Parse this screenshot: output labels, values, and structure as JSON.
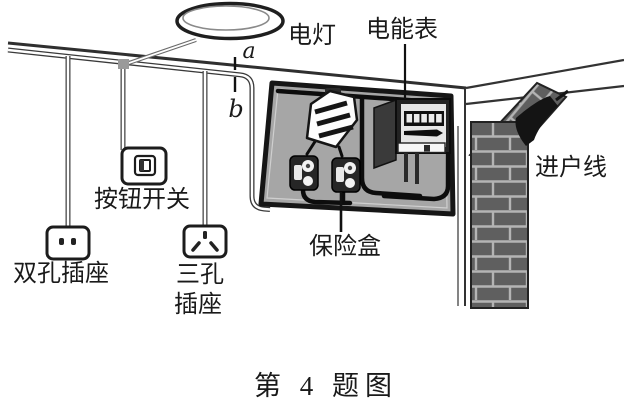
{
  "figure": {
    "type": "household-electric-circuit-diagram",
    "caption": "第 4 题图",
    "labels": {
      "lamp": "电灯",
      "energy_meter": "电能表",
      "service_entrance_line": "进户线",
      "push_button_switch": "按钮开关",
      "two_hole_socket": "双孔插座",
      "three_hole_socket_line1": "三孔",
      "three_hole_socket_line2": "插座",
      "fuse_box": "保险盒",
      "point_a": "a",
      "point_b": "b"
    },
    "colors": {
      "ink": "#1a1a1a",
      "panel_fill": "#a6a6a6",
      "brick_fill": "#5f5f5f",
      "mortar": "#b4b4b4",
      "background": "#ffffff"
    }
  }
}
